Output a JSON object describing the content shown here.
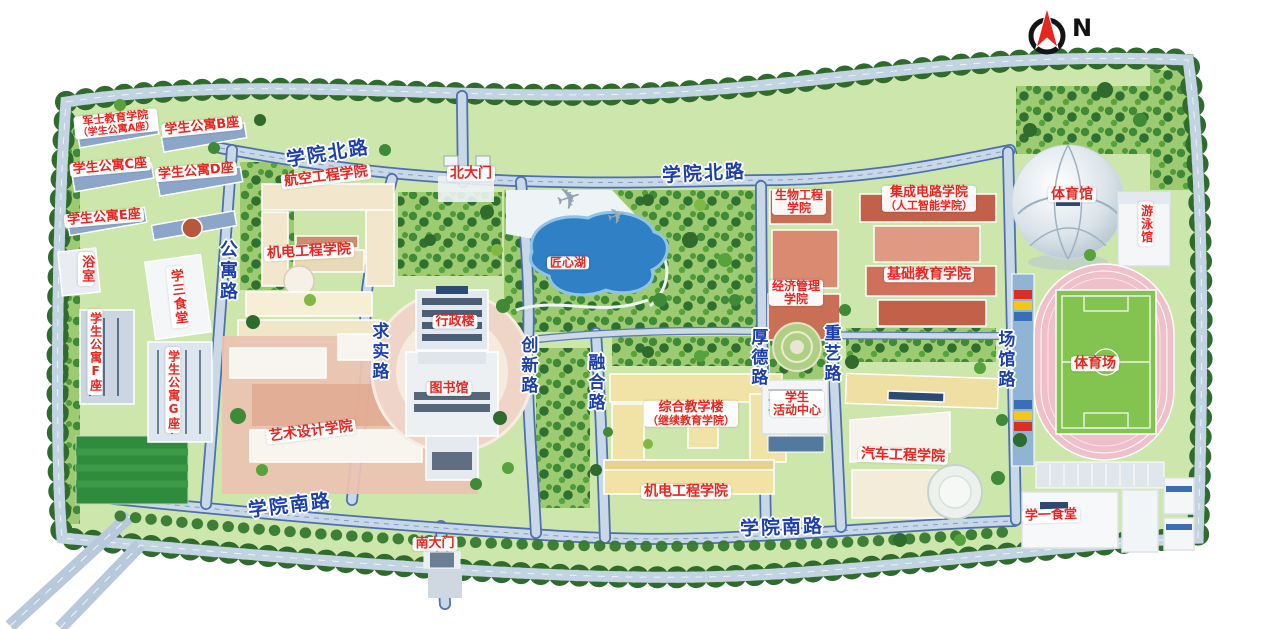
{
  "compass": {
    "north_label": "N"
  },
  "gates": {
    "north_gate": "北大门",
    "south_gate": "南大门"
  },
  "roads": {
    "north_road": "学院北路",
    "south_road": "学院南路",
    "gongyu_road": "公寓路",
    "qiushi_road": "求实路",
    "chuangxin_road": "创新路",
    "ronghe_road": "融合路",
    "houde_road": "厚德路",
    "zhongyi_road": "重艺路",
    "changguan_road": "场馆路"
  },
  "places": {
    "junshi_line1": "军士教育学院",
    "junshi_line2": "（学生公寓A座）",
    "dorm_b": "学生公寓B座",
    "dorm_c": "学生公寓C座",
    "dorm_d": "学生公寓D座",
    "dorm_e": "学生公寓E座",
    "dorm_f": "学生公寓F座",
    "dorm_g": "学生公寓G座",
    "bathhouse": "浴室",
    "canteen_3": "学三食堂",
    "canteen_1": "学一食堂",
    "aviation_college": "航空工程学院",
    "mech_college_north": "机电工程学院",
    "mech_college_south": "机电工程学院",
    "art_college": "艺术设计学院",
    "admin_building": "行政楼",
    "library": "图书馆",
    "lake": "匠心湖",
    "bio_line1": "生物工程",
    "bio_line2": "学院",
    "econ_line1": "经济管理",
    "econ_line2": "学院",
    "ic_line1": "集成电路学院",
    "ic_line2": "（人工智能学院）",
    "basic_edu_college": "基础教育学院",
    "comprehensive_line1": "综合教学楼",
    "comprehensive_line2": "（继续教育学院）",
    "student_center_line1": "学生",
    "student_center_line2": "活动中心",
    "auto_college": "汽车工程学院",
    "gymnasium": "体育馆",
    "swimming_pool": "游泳馆",
    "stadium": "体育场"
  }
}
